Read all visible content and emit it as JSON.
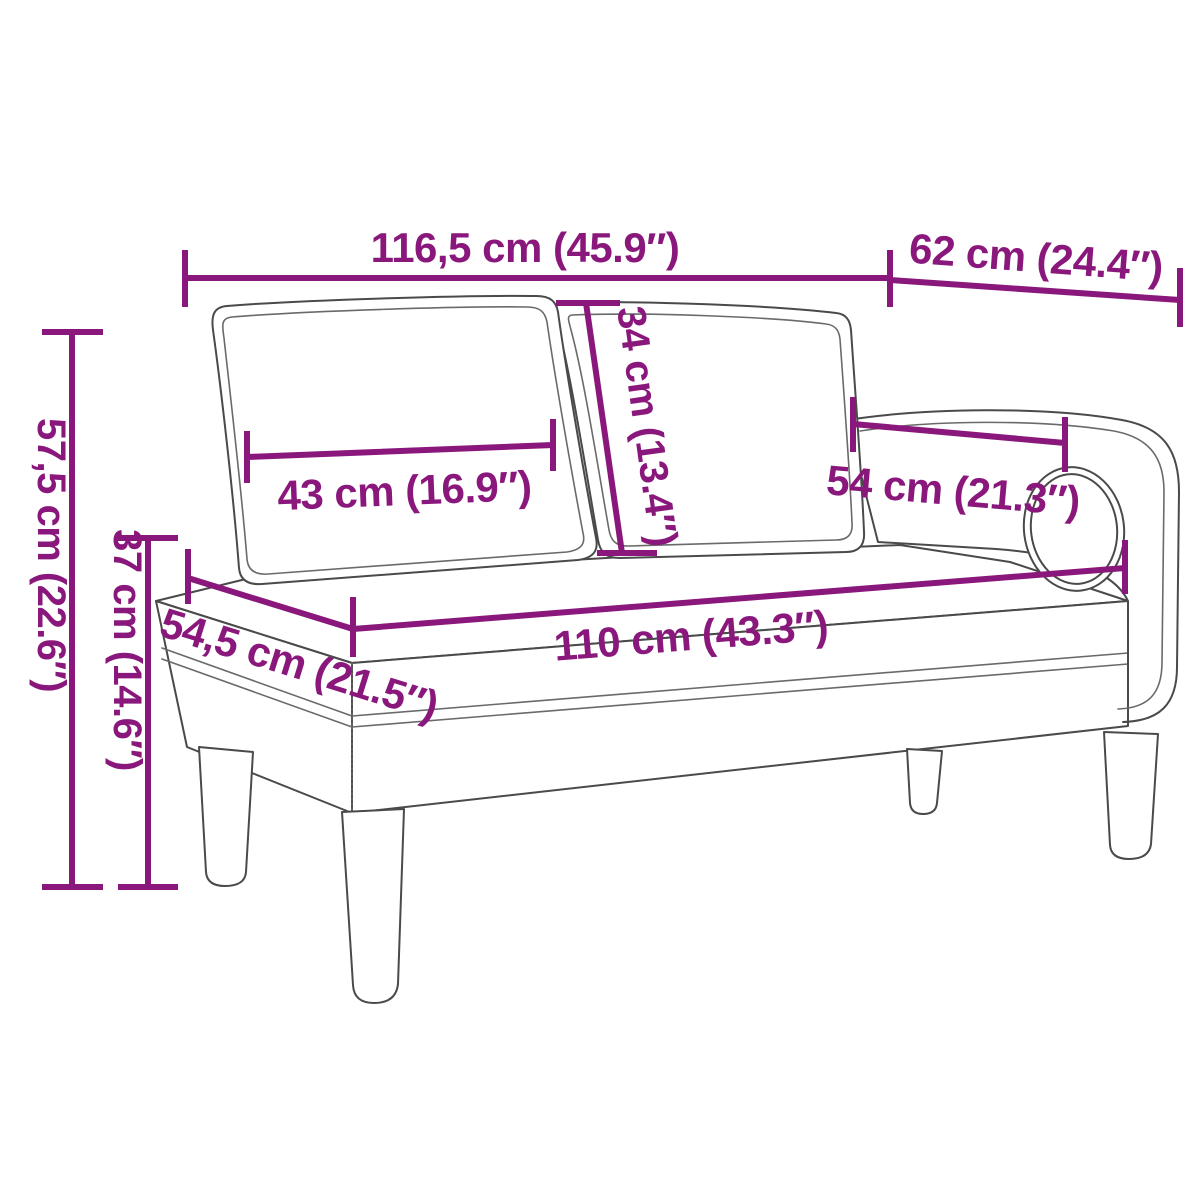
{
  "diagram": {
    "type": "product-dimension-diagram",
    "subject": "chaise-lounge-with-back-cushions-and-bolster",
    "colors": {
      "accent": "#8A187C",
      "outline": "#4a4a4a",
      "background": "#ffffff"
    },
    "dims": {
      "total_width": {
        "label": "116,5 cm (45.9″)",
        "meaning": "overall width (back section)"
      },
      "arm_depth": {
        "label": "62 cm (24.4″)",
        "meaning": "overall depth (arm section)"
      },
      "total_height": {
        "label": "57,5 cm (22.6″)",
        "meaning": "overall height"
      },
      "seat_height": {
        "label": "37 cm (14.6″)",
        "meaning": "seat height from floor"
      },
      "back_cushion_width": {
        "label": "43 cm (16.9″)",
        "meaning": "back cushion width"
      },
      "back_cushion_height": {
        "label": "34 cm (13.4″)",
        "meaning": "back cushion height"
      },
      "armrest_length": {
        "label": "54 cm (21.3″)",
        "meaning": "armrest length"
      },
      "seat_depth": {
        "label": "54,5 cm (21.5″)",
        "meaning": "seat depth"
      },
      "seat_width": {
        "label": "110 cm (43.3″)",
        "meaning": "seat width"
      }
    }
  }
}
